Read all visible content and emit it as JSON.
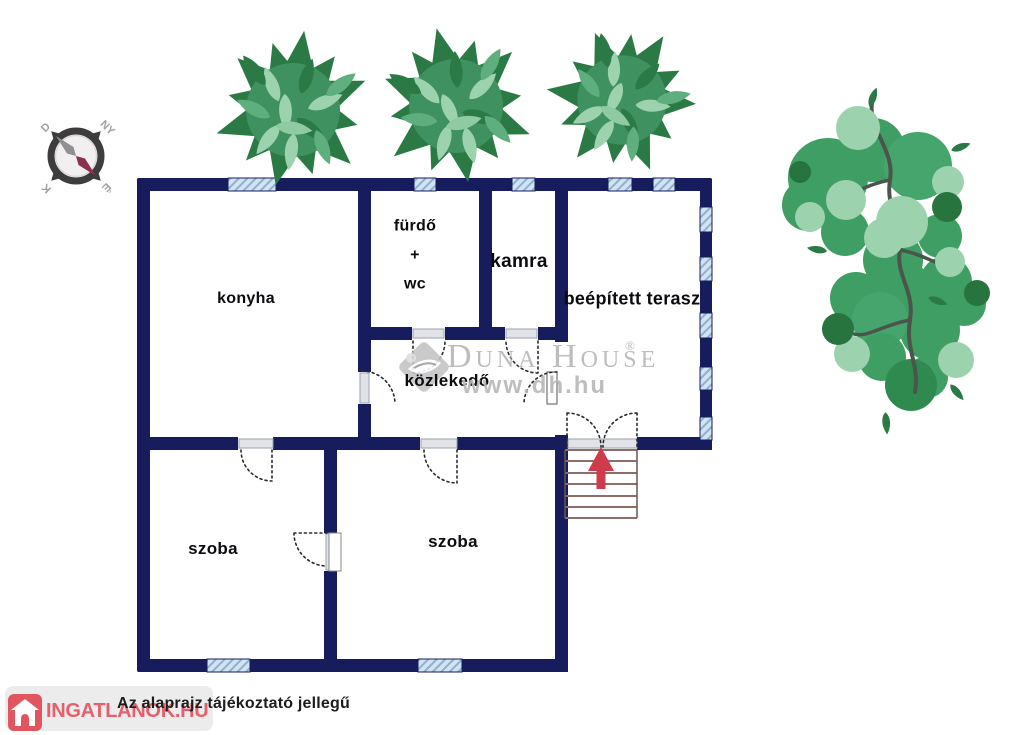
{
  "compass": {
    "north_label": "É",
    "south_label": "D",
    "east_label": "K",
    "west_label": "NY"
  },
  "rooms": {
    "konyha": "konyha",
    "furdo_line1": "fürdő",
    "furdo_line2": "+",
    "furdo_line3": "wc",
    "kamra": "kamra",
    "terasz": "beépített terasz",
    "kozlekedo": "közlekedő",
    "szoba_left": "szoba",
    "szoba_right": "szoba"
  },
  "watermarks": {
    "duna_house_brand": "Duna House",
    "duna_house_registered": "®",
    "duna_house_url": "www.dh.hu",
    "ingatlanok_text": "INGATLANOK.HU"
  },
  "footer": {
    "disclaimer": "Az alaprajz tájékoztató jellegű"
  },
  "colors": {
    "wall": "#171d5c",
    "window_fill": "#d2e4f2",
    "window_hatch": "#8fb0cf",
    "arrow_red": "#cf3a4d",
    "stair_line": "#8d6e68",
    "tree_dark": "#2b7a45",
    "tree_mid": "#3f9e63",
    "tree_light": "#9dd2ae",
    "watermark_gray": "#b2b2b2",
    "brand_red": "#e15561"
  }
}
